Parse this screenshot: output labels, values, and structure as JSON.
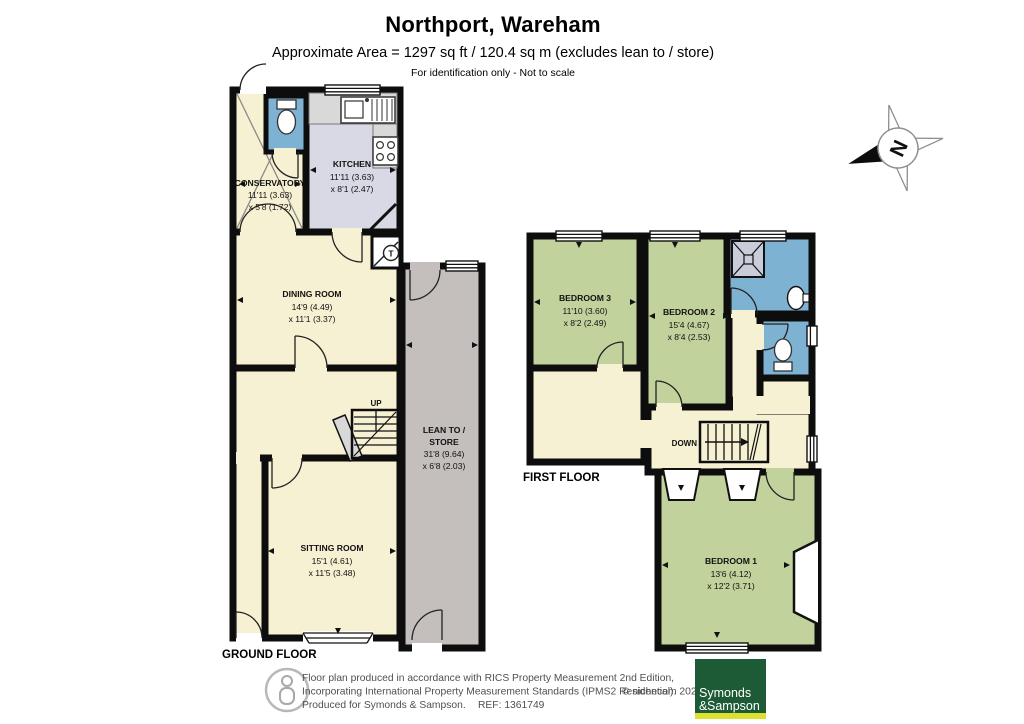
{
  "header": {
    "title": "Northport, Wareham",
    "area": "Approximate Area = 1297 sq ft / 120.4 sq m (excludes lean to / store)",
    "disclaimer": "For identification only - Not to scale"
  },
  "compass": {
    "north": "N"
  },
  "ground_floor": {
    "floor_label": "GROUND FLOOR",
    "up_label": "UP",
    "tank_label": "T",
    "conservatory": {
      "name": "CONSERVATORY",
      "dim1": "11'11 (3.63)",
      "dim2": "x 5'8 (1.72)"
    },
    "kitchen": {
      "name": "KITCHEN",
      "dim1": "11'11 (3.63)",
      "dim2": "x 8'1 (2.47)"
    },
    "dining_room": {
      "name": "DINING ROOM",
      "dim1": "14'9 (4.49)",
      "dim2": "x 11'1 (3.37)"
    },
    "lean_to": {
      "name_line1": "LEAN TO /",
      "name_line2": "STORE",
      "dim1": "31'8 (9.64)",
      "dim2": "x 6'8 (2.03)"
    },
    "sitting_room": {
      "name": "SITTING ROOM",
      "dim1": "15'1 (4.61)",
      "dim2": "x 11'5 (3.48)"
    }
  },
  "first_floor": {
    "floor_label": "FIRST FLOOR",
    "down_label": "DOWN",
    "bedroom_3": {
      "name": "BEDROOM 3",
      "dim1": "11'10 (3.60)",
      "dim2": "x 8'2 (2.49)"
    },
    "bedroom_2": {
      "name": "BEDROOM 2",
      "dim1": "15'4 (4.67)",
      "dim2": "x 8'4 (2.53)"
    },
    "bedroom_1": {
      "name": "BEDROOM 1",
      "dim1": "13'6 (4.12)",
      "dim2": "x 12'2 (3.71)"
    }
  },
  "footer": {
    "line1": "Floor plan produced in accordance with RICS Property Measurement 2nd Edition,",
    "line2": "Incorporating International Property Measurement Standards (IPMS2 Residential).",
    "line3": "Produced for Symonds & Sampson.",
    "ref": "REF: 1361749",
    "copyright": "© nichecom 2025.",
    "logo": {
      "line1": "Symonds",
      "amp": "&",
      "line2": "Sampson"
    }
  },
  "colors": {
    "room_cream": "#f7f1d3",
    "room_green": "#c2d29d",
    "room_blue": "#7eb2d3",
    "room_gray": "#c4bfbd",
    "kitchen_floor": "#d8d9e4",
    "counter_gray": "#d9d9d9",
    "wall_black": "#0d0d0d",
    "logo_green": "#1d5b36",
    "logo_yellow": "#dce02f"
  }
}
